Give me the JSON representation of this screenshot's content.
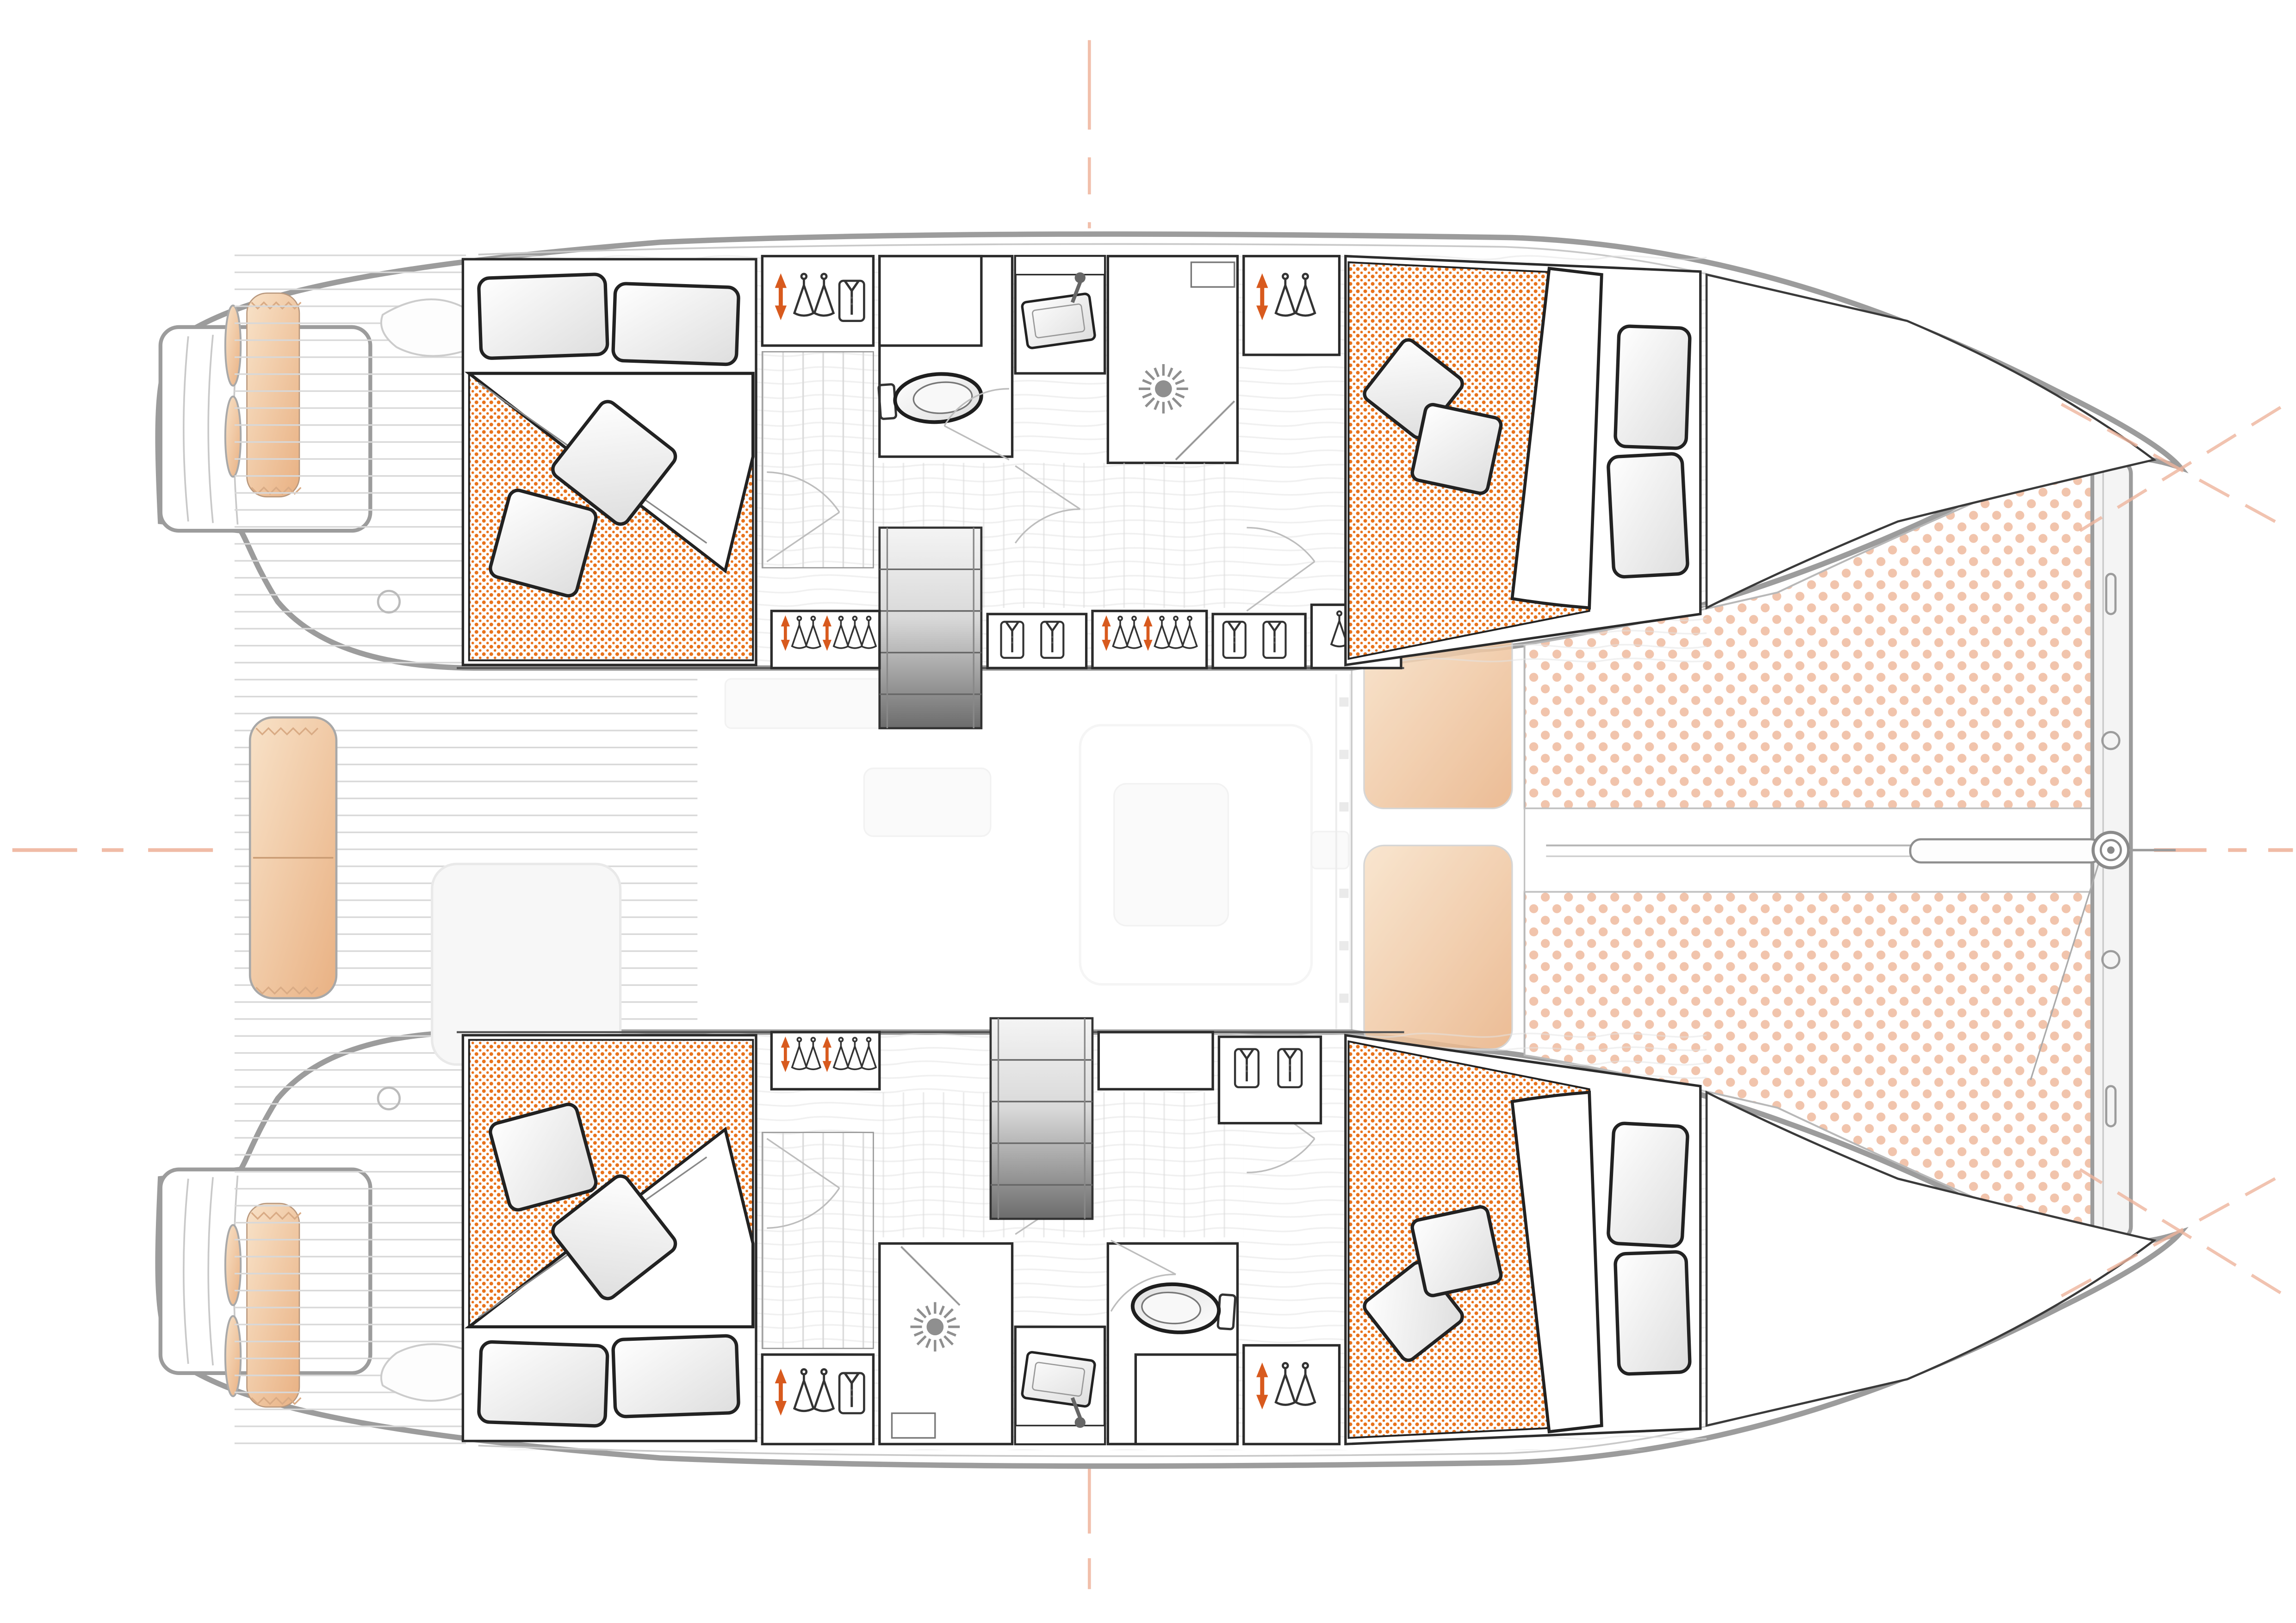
{
  "page": {
    "title": "Catamaran deck plan",
    "background": "#ffffff"
  },
  "diagram": {
    "type": "boat-floor-plan",
    "subject": "Sailing catamaran interior layout, top-down deck plan, bow to the right",
    "layout": "4 double cabins, 2 bathrooms, saloon ghosted, cockpit aft, twin bow trampolines",
    "orientation": {
      "bow": "right",
      "stern": "left",
      "port_hull": "top",
      "starboard_hull": "bottom"
    },
    "rooms": [
      {
        "id": "port-aft-cabin",
        "kind": "double-cabin",
        "bed": {
          "pillows": 2,
          "throw_pillows": 2,
          "duvet": "orange-dotted",
          "head_end": "aft-outboard"
        }
      },
      {
        "id": "port-bathroom",
        "kind": "bathroom",
        "fixtures": [
          "toilet",
          "washbasin",
          "shower-with-sun-drain"
        ]
      },
      {
        "id": "port-forward-cabin",
        "kind": "double-cabin",
        "bed": {
          "pillows": 2,
          "throw_pillows": 2,
          "duvet": "orange-dotted",
          "head_end": "forward"
        }
      },
      {
        "id": "port-forepeak",
        "kind": "storage"
      },
      {
        "id": "starboard-aft-cabin",
        "kind": "double-cabin",
        "bed": {
          "pillows": 2,
          "throw_pillows": 2,
          "duvet": "orange-dotted",
          "head_end": "aft-outboard"
        }
      },
      {
        "id": "starboard-bathroom",
        "kind": "bathroom",
        "fixtures": [
          "shower-with-sun-drain",
          "washbasin",
          "toilet"
        ]
      },
      {
        "id": "starboard-forward-cabin",
        "kind": "double-cabin",
        "bed": {
          "pillows": 2,
          "throw_pillows": 2,
          "duvet": "orange-dotted",
          "head_end": "forward"
        }
      },
      {
        "id": "starboard-forepeak",
        "kind": "storage"
      },
      {
        "id": "saloon",
        "kind": "saloon",
        "rendered": "ghosted-faint"
      },
      {
        "id": "cockpit",
        "kind": "aft-deck",
        "features": [
          "teak-planking",
          "tan-lounge-cushion",
          "ghost-table",
          "winches"
        ]
      },
      {
        "id": "transoms",
        "kind": "swim-platforms",
        "features": [
          "steps",
          "fenders",
          "tan-cushions"
        ]
      },
      {
        "id": "foredeck",
        "kind": "deck",
        "features": [
          "two-tan-sunpads"
        ]
      },
      {
        "id": "trampolines",
        "kind": "netting",
        "count": 2,
        "pattern": "salmon-dots"
      },
      {
        "id": "bow-assembly",
        "kind": "crossbeam",
        "features": [
          "bowsprit",
          "furler-drum",
          "anchor-line",
          "beam-slots"
        ]
      }
    ],
    "stairs": {
      "count": 2,
      "style": "grey-gradient-steps",
      "locations": [
        "port-hull-entry",
        "starboard-hull-entry"
      ]
    },
    "storage_lockers": {
      "hanging_lockers": 8,
      "hanger_rows": [
        3,
        7,
        3,
        7,
        2,
        3,
        7,
        3
      ],
      "orange_arrow_markers": true,
      "folded_shirt_lockers": 3
    },
    "reference_lines": {
      "longitudinal_centerline": "dashed-salmon",
      "transverse_centerline": "dashed-salmon",
      "bow-cross-marks": 2
    },
    "colors": {
      "background": "#ffffff",
      "hullOutline": "#9c9c9c",
      "hullInner": "#c9c9c9",
      "furnitureLine": "#2b2b2b",
      "duvetDot": "#e8721b",
      "trampolineDot": "#f1c4ac",
      "cushionTan": "#e9b183",
      "cushionTanLight": "#f8e2c8",
      "teakLine": "#d8d8d8",
      "plankLine": "#dadada",
      "woodGrain": "#e3e3e3",
      "centerline": "#eeb49c",
      "stairsDark": "#6c6c6c",
      "hangerOrange": "#d85a1e",
      "iconLine": "#333333",
      "ghost": "#e9e9e9",
      "speckle": "#bdbdbd",
      "sunDrain": "#8f8f8f",
      "pillowShade": "#dedede"
    }
  }
}
